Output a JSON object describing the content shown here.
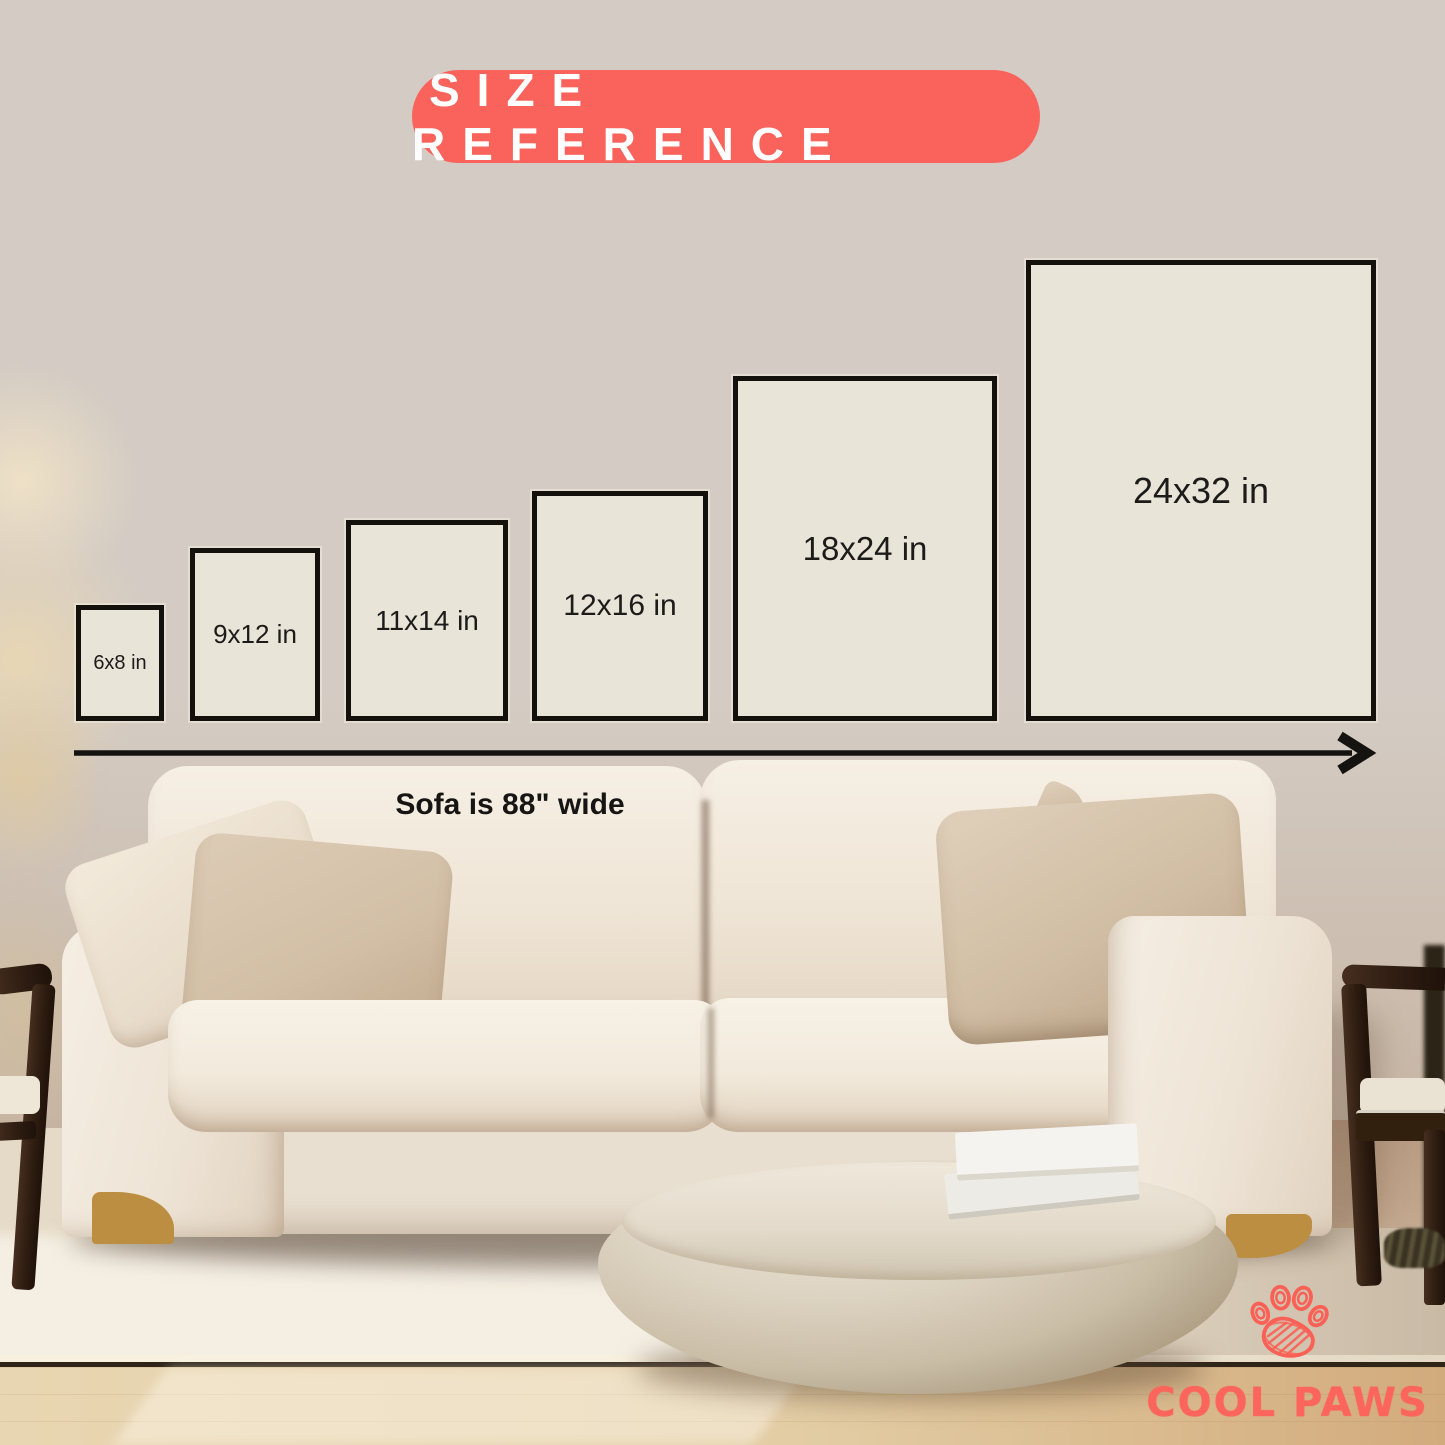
{
  "badge": {
    "label": "SIZE REFERENCE",
    "bg_color": "#f9635c",
    "text_color": "#ffffff"
  },
  "sizes": [
    {
      "label": "6x8 in",
      "width_in": 6,
      "height_in": 8
    },
    {
      "label": "9x12 in",
      "width_in": 9,
      "height_in": 12
    },
    {
      "label": "11x14 in",
      "width_in": 11,
      "height_in": 14
    },
    {
      "label": "12x16 in",
      "width_in": 12,
      "height_in": 16
    },
    {
      "label": "18x24 in",
      "width_in": 18,
      "height_in": 24
    },
    {
      "label": "24x32 in",
      "width_in": 24,
      "height_in": 32
    }
  ],
  "poster_style": {
    "fill_color": "#e9e4d8",
    "border_color": "#14110d"
  },
  "scale_reference": {
    "label": "Sofa is 88\" wide",
    "arrow_icon": "arrow-right-icon"
  },
  "brand": {
    "name": "COOL PAWS",
    "logo_icon": "paw-print-icon",
    "color": "#fb655b"
  }
}
